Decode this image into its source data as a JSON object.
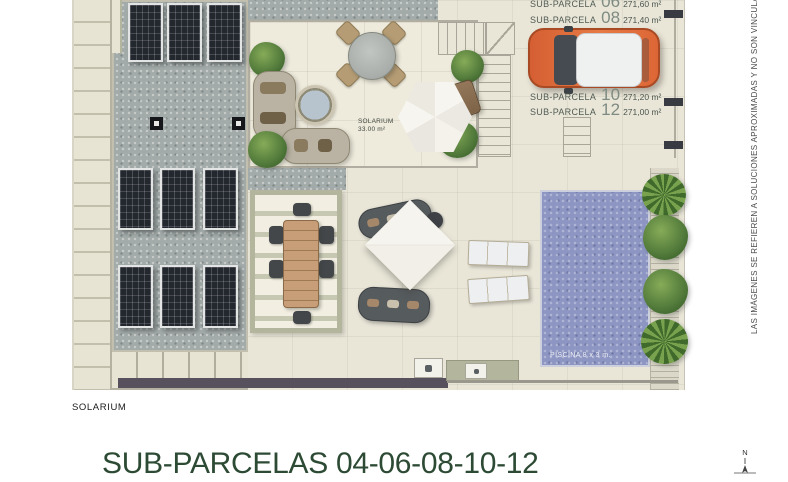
{
  "document": {
    "caption": "SOLARIUM",
    "title": "SUB-PARCELAS 04-06-08-10-12",
    "compass_north": "N",
    "side_note": "LAS IMÁGENES SE REFIEREN A SOLUCIONES APROXIMADAS Y NO SON VINCULANTES AL PR"
  },
  "plan": {
    "solarium": {
      "label": "SOLARIUM",
      "area": "33.00 m²"
    },
    "pool": {
      "label": "PISCINA 8 x 3 m."
    },
    "parcels": [
      {
        "label": "SUB-PARCELA",
        "number": "06",
        "area": "271,60 m²"
      },
      {
        "label": "SUB-PARCELA",
        "number": "08",
        "area": "271,40 m²"
      },
      {
        "label": "SUB-PARCELA",
        "number": "10",
        "area": "271,20 m²"
      },
      {
        "label": "SUB-PARCELA",
        "number": "12",
        "area": "271,00 m²"
      }
    ]
  },
  "colors": {
    "car_accent": "#e2673a",
    "pool_water": "#8d96c3",
    "title_green": "#2c4a34",
    "concrete_gray": "#a3abaa",
    "floor_beige": "#e9e6d8",
    "wall_dark": "#56515d"
  }
}
